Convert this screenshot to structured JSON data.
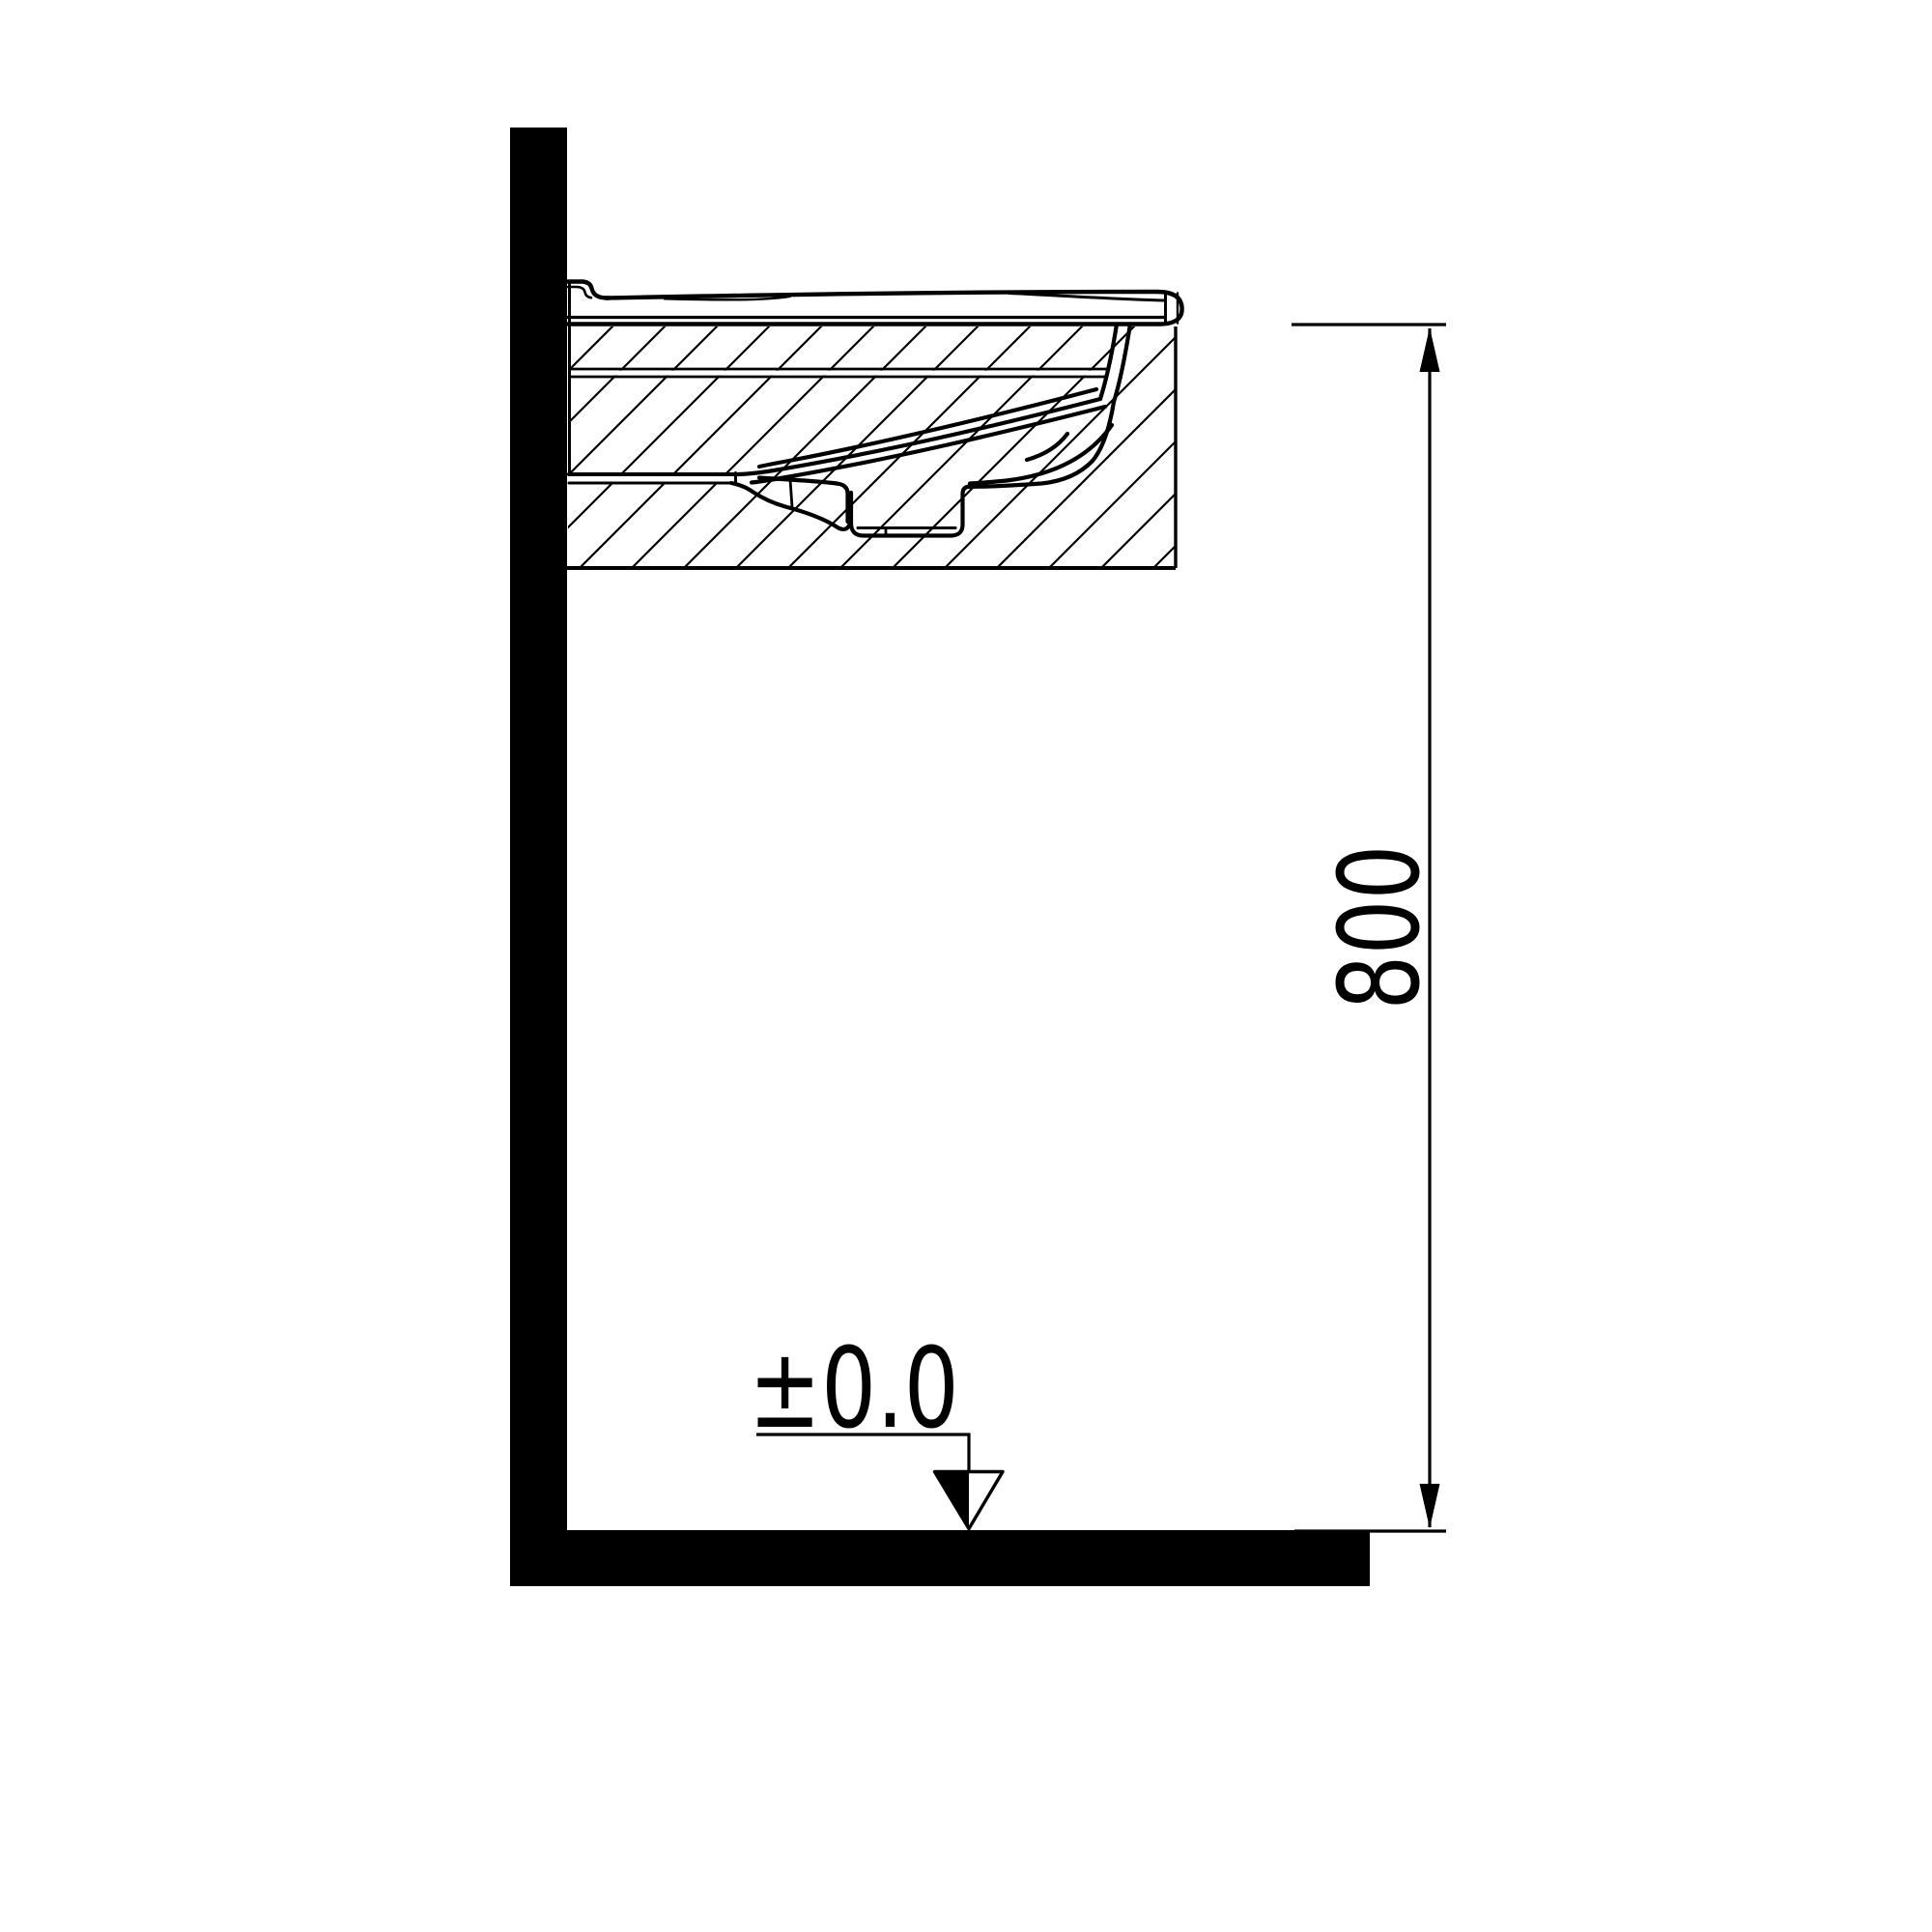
{
  "labels": {
    "height_dimension": "800",
    "datum_level": "±0.0"
  },
  "colors": {
    "ink": "#000000",
    "paper": "#ffffff"
  },
  "drawing": {
    "kind": "washbasin-installation-side-section",
    "dimension_value_mm": "800",
    "datum_value": "±0.0"
  }
}
